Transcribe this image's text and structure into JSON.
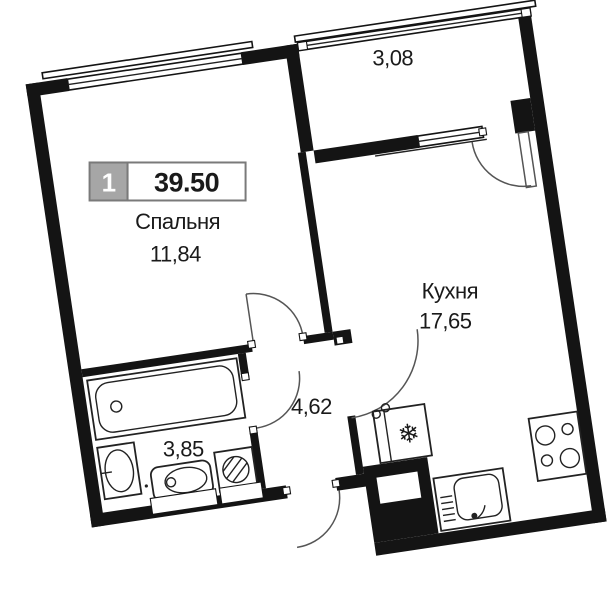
{
  "plan": {
    "badge": {
      "unit_number": "1",
      "total_area": "39.50"
    },
    "rooms": {
      "bedroom": {
        "name": "Спальня",
        "area": "11,84"
      },
      "kitchen": {
        "name": "Кухня",
        "area": "17,65"
      },
      "hallway": {
        "area": "4,62"
      },
      "bathroom": {
        "area": "3,85"
      },
      "balcony": {
        "area": "3,08"
      }
    },
    "icons": {
      "fridge": "❄"
    },
    "colors": {
      "wall": "#141414",
      "background": "#ffffff",
      "badge_gray": "#a6a6a6",
      "badge_border": "#7a7a7a",
      "text": "#1a1a1a",
      "door_arc": "#555555"
    }
  }
}
